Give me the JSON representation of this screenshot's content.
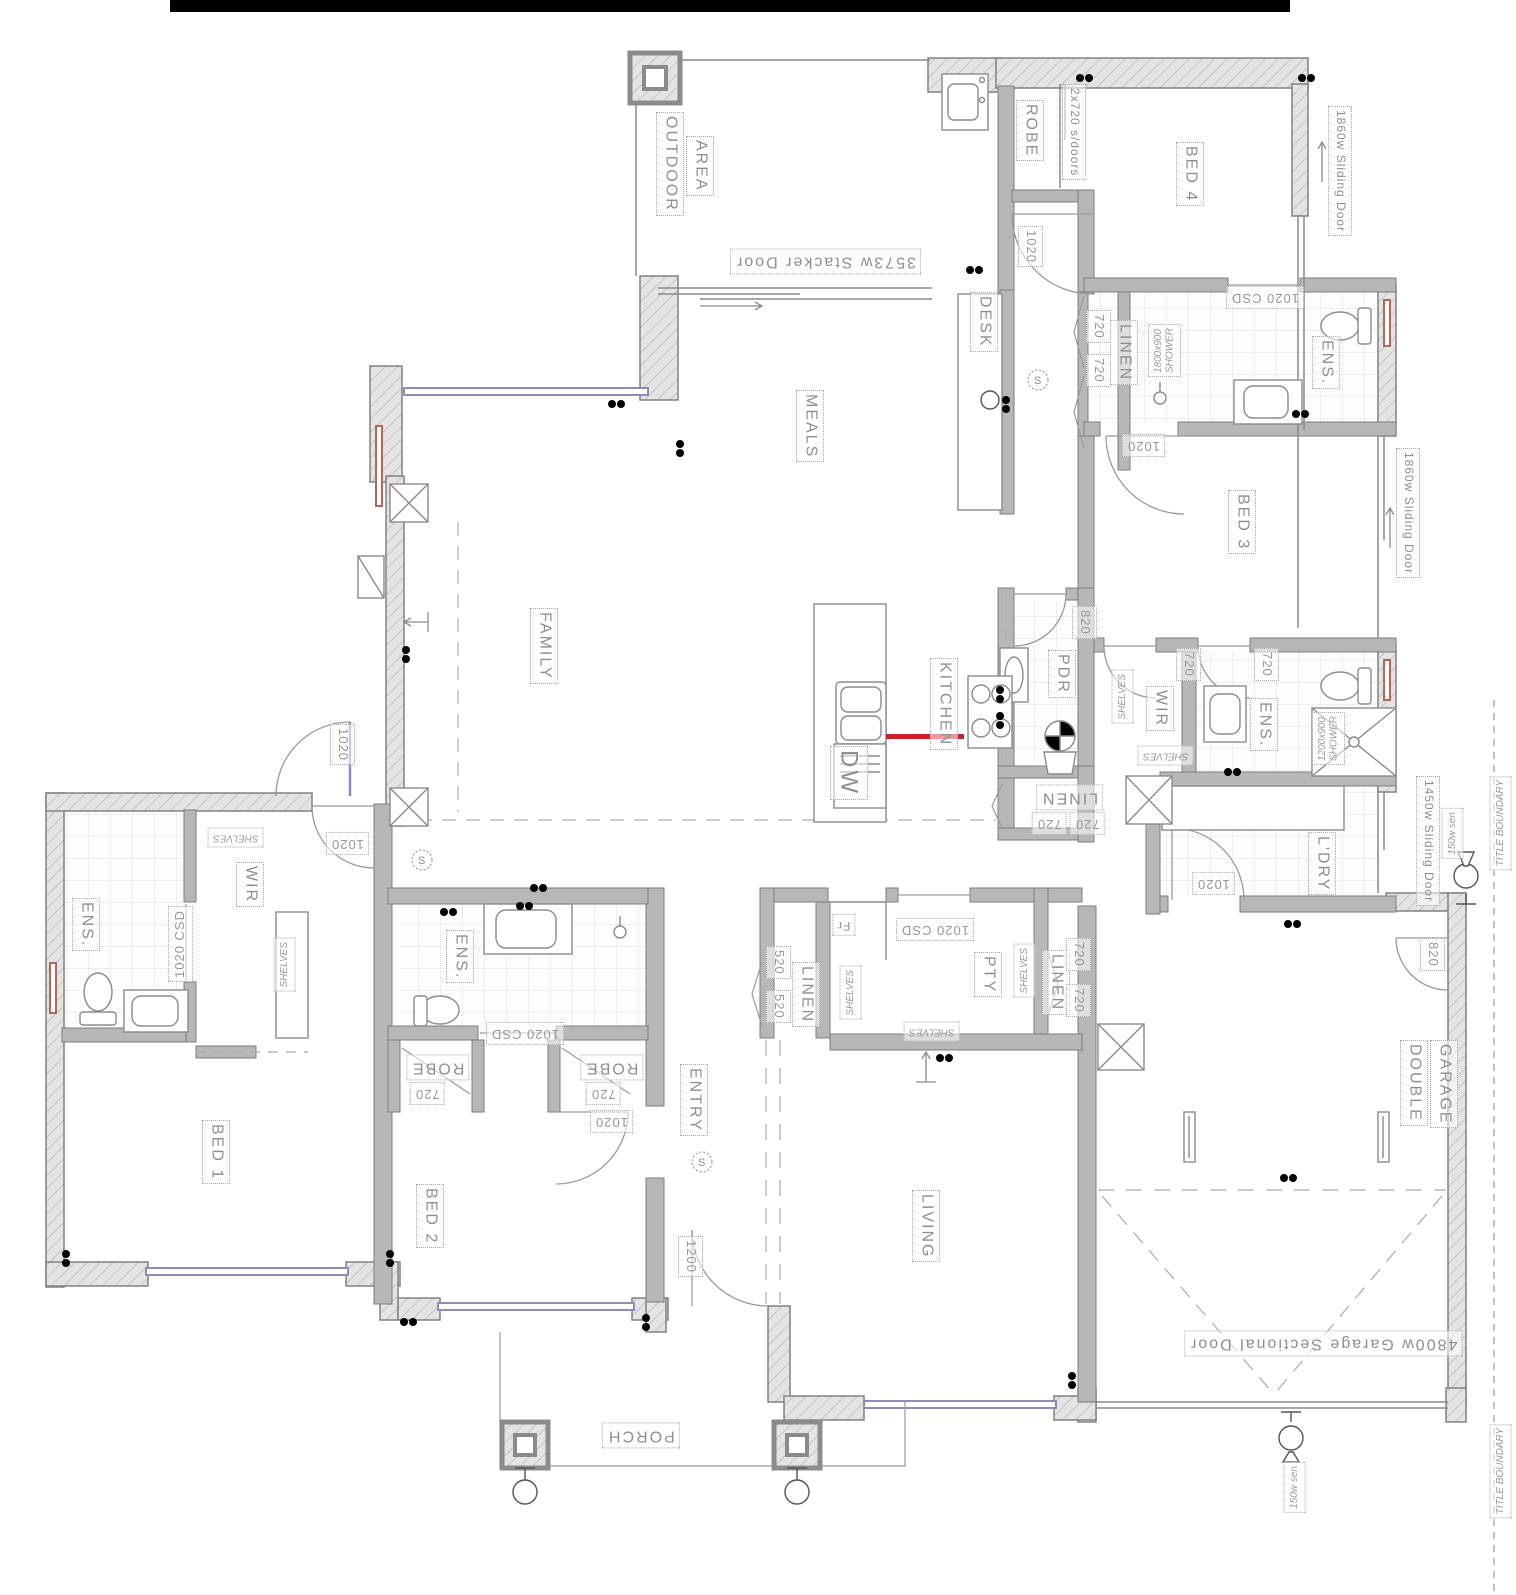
{
  "t": {
    "outdoor1": "OUTDOOR",
    "outdoor2": "AREA",
    "stacker": "3573w Stacker Door",
    "robe": "ROBE",
    "sdoors": "2x720 s/doors",
    "bed4": "BED 4",
    "slide": "1860w Sliding Door",
    "slide_ldry": "1450w Sliding Door",
    "garage_door": "4800w Garage Sectional Door",
    "d1020": "1020",
    "csd": "1020 CSD",
    "d820": "820",
    "d720": "720",
    "d520": "520",
    "d1200": "1200",
    "shower4": "1800x900\nSHOWER",
    "shower3": "1200x900\nSHOWER",
    "ens": "ENS.",
    "linen": "LINEN",
    "bed3": "BED 3",
    "desk": "DESK",
    "meals": "MEALS",
    "family": "FAMILY",
    "kitchen": "KITCHEN",
    "dw": "DW",
    "fr": "Fr",
    "pdr": "PDR",
    "pty": "PTY",
    "shelves": "SHELVES",
    "wir": "WIR",
    "ldry": "L'DRY",
    "sen": "150w sen",
    "boundary": "TITLE BOUNDARY",
    "bed1": "BED 1",
    "bed2": "BED 2",
    "entry": "ENTRY",
    "living": "LIVING",
    "garage1": "DOUBLE",
    "garage2": "GARAGE",
    "porch": "PORCH",
    "s": "S"
  }
}
